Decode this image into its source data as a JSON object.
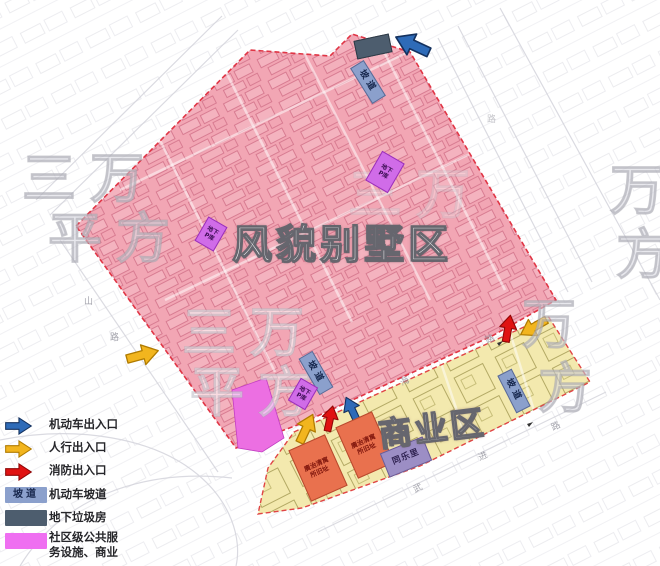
{
  "legend": {
    "items": [
      {
        "type": "arrow",
        "color": "#2e6bb8",
        "label": "机动车出入口"
      },
      {
        "type": "arrow",
        "color": "#f2b51e",
        "label": "人行出入口"
      },
      {
        "type": "arrow",
        "color": "#e01212",
        "label": "消防出入口"
      },
      {
        "type": "box",
        "color": "#8ba0cc",
        "box_text": "坡道",
        "label": "机动车坡道"
      },
      {
        "type": "box",
        "color": "#4d5d6e",
        "label": "地下垃圾房"
      },
      {
        "type": "box",
        "color": "#ef6ff1",
        "label_line1": "社区级公共服",
        "label_line2": "务设施、商业"
      }
    ]
  },
  "map": {
    "villa_area_label": "风貌别墅区",
    "commercial_area_label": "商业区",
    "ramp_label": "坡道",
    "underground_parking": {
      "line1": "地下",
      "line2": "P库"
    },
    "heritage_site": {
      "line1": "廣治清寓",
      "line2": "所旧址"
    },
    "tongle_li_label": "同乐里",
    "road_labels": {
      "west": [
        "山",
        "路"
      ],
      "central": [
        "海",
        "路"
      ],
      "southeast": [
        "武",
        "进",
        "路"
      ],
      "northeast": [
        "路"
      ]
    },
    "watermark": {
      "row1": "三万",
      "row2": "平方",
      "wan": "万",
      "fang": "方"
    },
    "icons": [
      {
        "name": "vehicle-entrance-arrow",
        "color": "#2e6bb8"
      },
      {
        "name": "pedestrian-entrance-arrow",
        "color": "#f2b51e"
      },
      {
        "name": "fire-entrance-arrow",
        "color": "#e01212"
      }
    ]
  },
  "colors": {
    "villa_zone": "#f2a6b4",
    "commercial_zone": "#f3e9ae",
    "community_service": "#ee6ff0",
    "ramp_box": "#8ba0cc",
    "garbage_box": "#4d5d6e",
    "parking_box": "#d06ce8",
    "heritage_box": "#e9714e",
    "tongle_li_box": "#9c8ec5",
    "boundary_dash": "#e03545"
  }
}
